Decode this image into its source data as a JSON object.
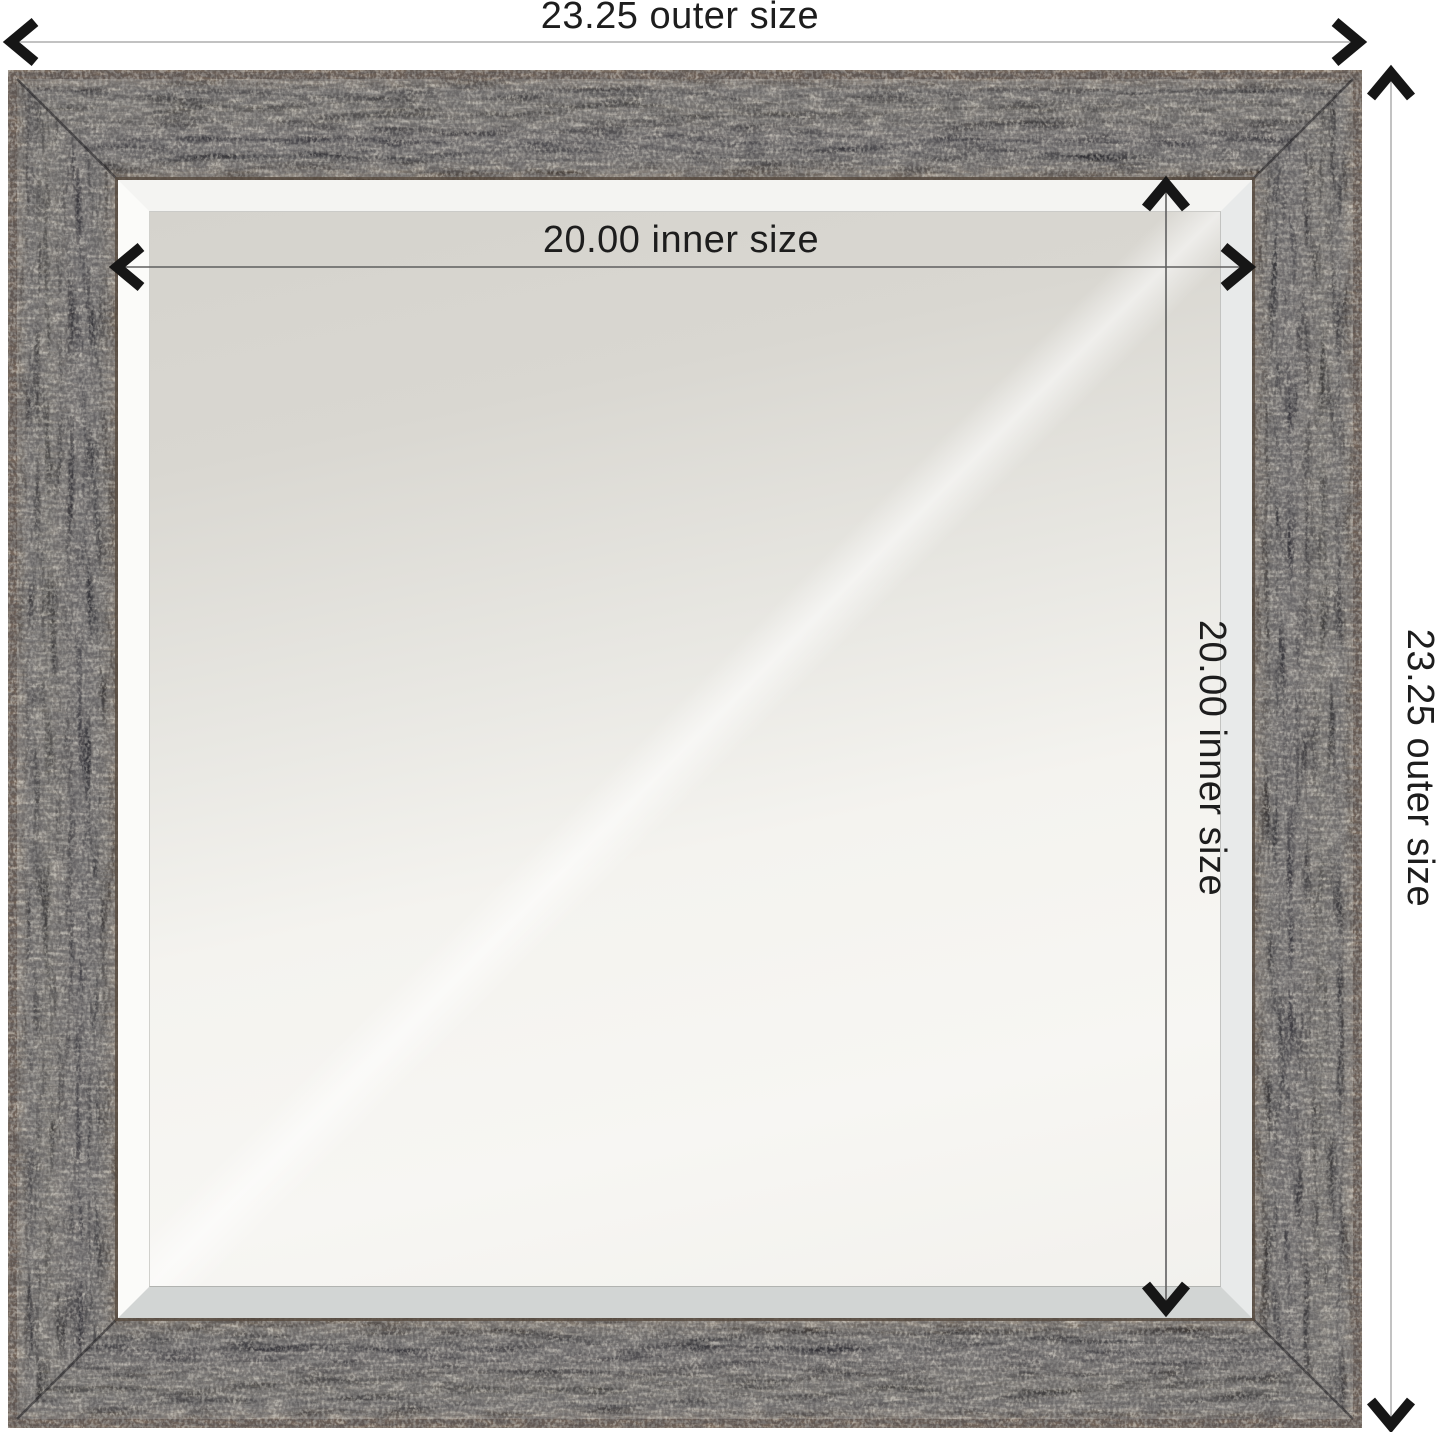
{
  "product": {
    "type": "square wall mirror with rustic distressed dark frame",
    "view": "front dimension diagram"
  },
  "dimensions": {
    "outer_width": {
      "value": "23.25",
      "label": "23.25 outer size"
    },
    "outer_height": {
      "value": "23.25",
      "label": "23.25 outer size"
    },
    "inner_width": {
      "value": "20.00",
      "label": "20.00 inner size"
    },
    "inner_height": {
      "value": "20.00",
      "label": "20.00 inner size"
    }
  },
  "colors": {
    "background": "#ffffff",
    "outer_dimension_line": "#c2c2c2",
    "inner_dimension_line": "#5f5f5f",
    "arrowhead": "#161616",
    "frame_dark": "#38373a",
    "frame_edge_brown": "#74655a",
    "mirror_gray": "#d5d3cd",
    "mirror_white": "#f7f6f3",
    "bevel_white": "#fbfbf9"
  }
}
